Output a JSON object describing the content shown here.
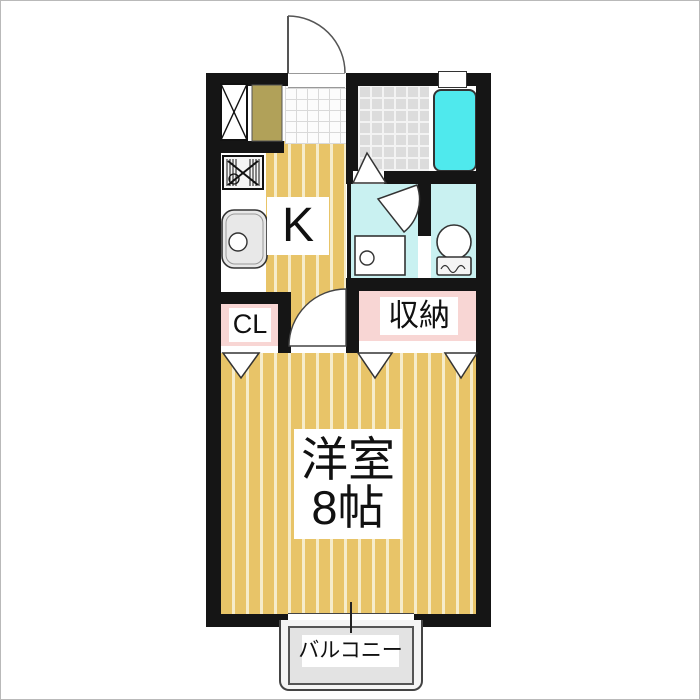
{
  "floorplan": {
    "rooms": {
      "kitchen": {
        "label": "K"
      },
      "closet": {
        "label": "CL"
      },
      "storage": {
        "label": "収納"
      },
      "main_room": {
        "label_line1": "洋室",
        "label_line2": "8帖"
      },
      "balcony": {
        "label": "バルコニー"
      }
    },
    "fixtures": [
      "entrance-door",
      "pipe-shaft",
      "shoe-cabinet",
      "gas-stove",
      "kitchen-sink",
      "bathtub",
      "bath-folding-door",
      "washroom-door",
      "washing-machine-pan",
      "toilet",
      "room-door",
      "closet-folding-doors",
      "sliding-window"
    ],
    "colors": {
      "wall": "#151515",
      "floor_tan": "#e8c468",
      "floor_stripe": "#f6ecca",
      "closet_pink": "#f8d6d4",
      "washroom_cyan": "#c9f1f1",
      "bathtub_cyan": "#4fe9ed",
      "bath_tile_gray": "#dcdcdc",
      "entry_tile": "#fcfcfc",
      "shoe_cabinet_olive": "#b1a159",
      "balcony_gray": "#e3e3e3",
      "label_background": "#ffffff",
      "text": "#111111"
    }
  }
}
